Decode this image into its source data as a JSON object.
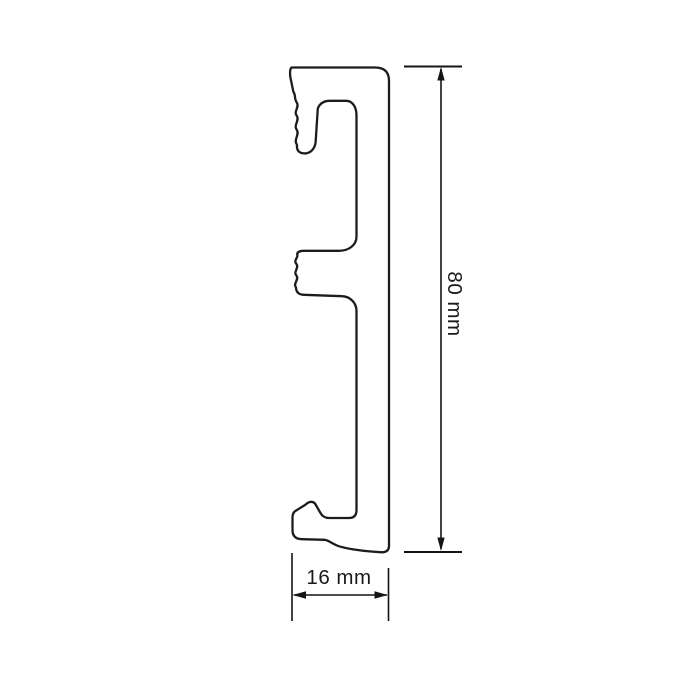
{
  "drawing": {
    "background_color": "#ffffff",
    "profile": {
      "outline_color": "#1c1c1c",
      "fill_color": "#ffffff",
      "path_d": "M 292 67.5 L 375 67.5 Q 389 67.5 389 81 L 389 546 Q 389 552 382 552.3 L 371 551.5 C 362 550.8 344 548.5 337 545.5 C 331 543 329 540.5 324.5 539.8 L 302 539.2 Q 292.5 539 292.5 530 L 292.5 517.5 Q 292.5 512 296.5 510.3 L 305 505 Q 311 499.5 315 503.5 L 320.5 513 Q 323 518 329.5 518 L 349 518 Q 356.5 518 356.5 510 L 356.5 311 C 356.5 302.5 350 296.5 342 296.2 L 304 294.8 Q 296.2 294.6 296 287.5 C 292.8 283.5 299.2 279.8 296.6 275.8 C 292.8 271.8 299.2 268.2 296.6 264.2 C 292.8 260.2 298.8 257.6 297.2 254.6 Q 297.2 250.8 303.8 250.8 L 339 250.8 C 348 250.8 356.5 245.8 356.5 236.5 L 356.5 115.5 C 356.5 107 352.5 100.8 346 100.8 L 330 100.8 Q 320.8 100.8 317.8 108.5 L 315.8 139.5 C 315.8 148.5 310.5 153.8 303.8 153.4 Q 296.2 152.8 297 144.8 C 293.2 139.8 299.8 134.8 296.8 129.8 C 293.2 125.2 299.8 120.6 296.8 115.8 C 293.2 111.4 299.8 107.2 296.8 102.6 C 294 98.8 296 95.5 293.4 91.8 L 290.2 76.5 Q 289.6 67.5 292 67.5 Z"
    },
    "dimensions": {
      "line_color": "#141414",
      "height": {
        "label": "80 mm",
        "value": 80,
        "unit": "mm",
        "orientation": "vertical"
      },
      "width": {
        "label": "16 mm",
        "value": 16,
        "unit": "mm",
        "orientation": "horizontal"
      }
    }
  }
}
